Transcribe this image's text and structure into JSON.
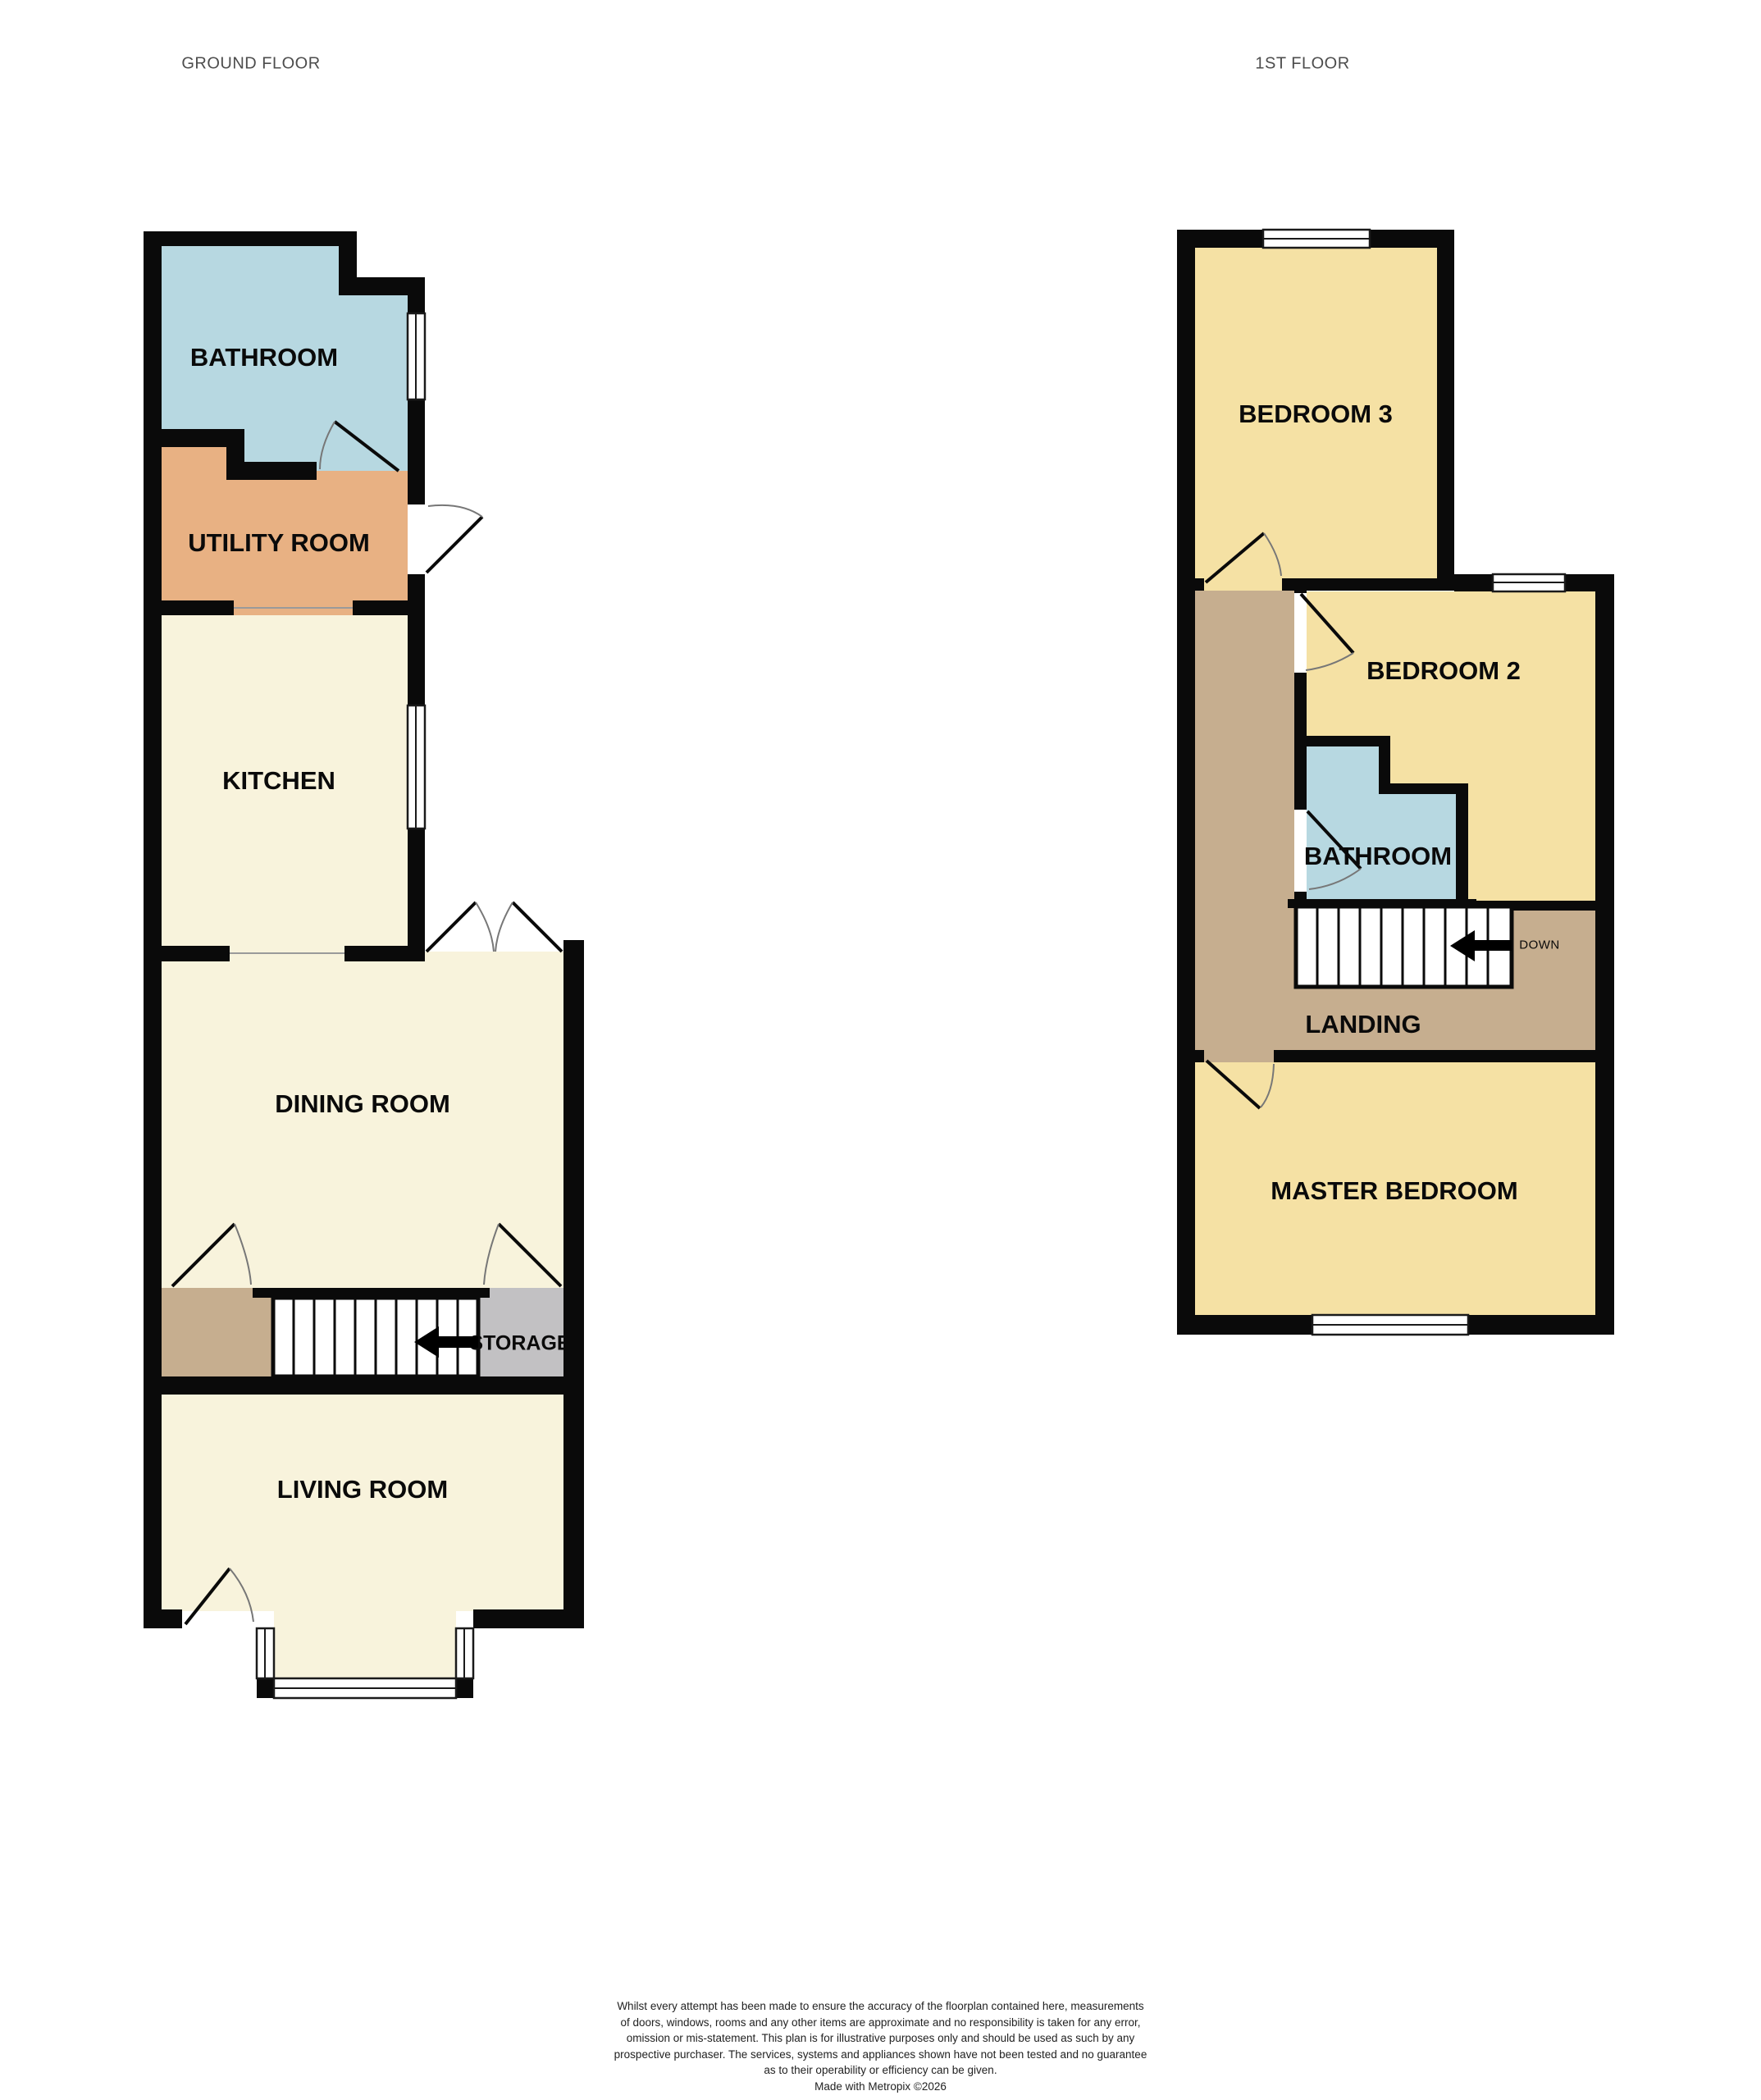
{
  "titles": {
    "ground_floor": "GROUND FLOOR",
    "first_floor": "1ST FLOOR"
  },
  "ground_floor": {
    "rooms": {
      "bathroom": "BATHROOM",
      "utility": "UTILITY ROOM",
      "kitchen": "KITCHEN",
      "dining": "DINING ROOM",
      "storage": "STORAGE",
      "living": "LIVING ROOM"
    }
  },
  "first_floor": {
    "rooms": {
      "bedroom3": "BEDROOM 3",
      "bedroom2": "BEDROOM 2",
      "bathroom": "BATHROOM",
      "landing": "LANDING",
      "master": "MASTER BEDROOM"
    },
    "stairs_label": "DOWN"
  },
  "colors": {
    "wall": "#0a0a0a",
    "cream": "#f8f3dc",
    "yellow": "#f5e1a4",
    "blue": "#b7d8e1",
    "orange": "#e8b183",
    "tan": "#c6ae8f",
    "gray": "#c2c1c3",
    "window_line": "#1a1a1a",
    "arc": "#777777",
    "threshold": "#9a9a9a"
  },
  "disclaimer": {
    "lines": [
      "Whilst every attempt has been made to ensure the accuracy of the floorplan contained here, measurements",
      "of doors, windows, rooms and any other items are approximate and no responsibility is taken for any error,",
      "omission or mis-statement. This plan is for illustrative purposes only and should be used as such by any",
      "prospective purchaser. The services, systems and appliances shown have not been tested and no guarantee",
      "as to their operability or efficiency can be given.",
      "Made with Metropix ©2026"
    ]
  }
}
